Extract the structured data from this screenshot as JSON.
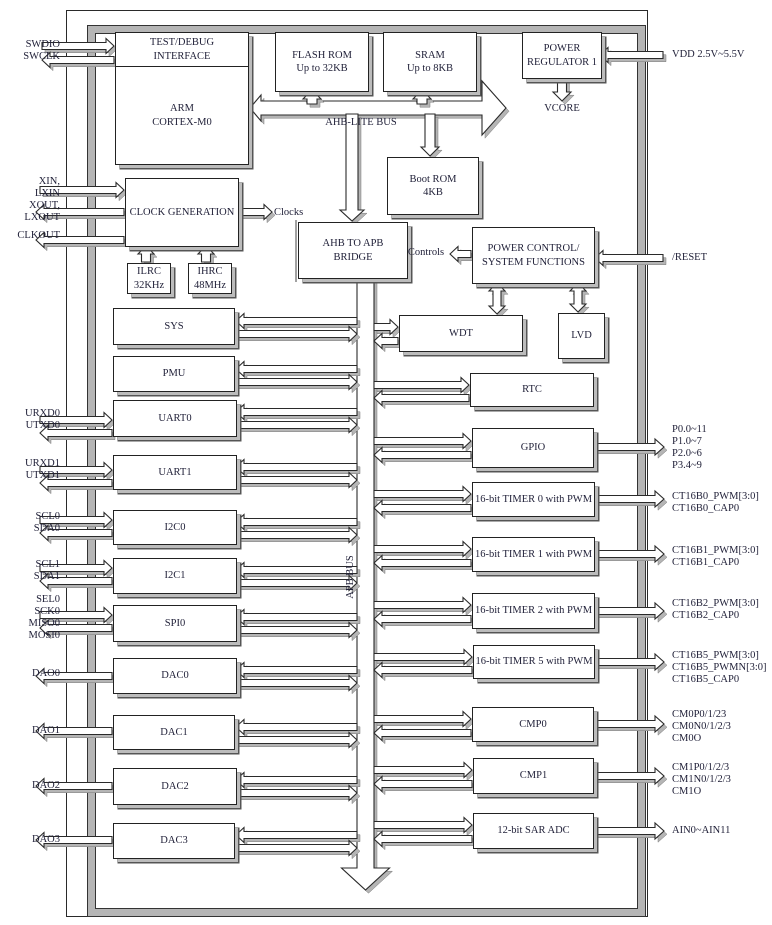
{
  "colors": {
    "line": "#2a2a2a",
    "shadow": "#b5b5b5",
    "text": "#22223a",
    "background": "#ffffff"
  },
  "blocks": {
    "test_debug": "TEST/DEBUG\nINTERFACE",
    "arm": "ARM\nCORTEX-M0",
    "flash": "FLASH ROM\nUp to 32KB",
    "sram": "SRAM\nUp to 8KB",
    "power_regulator": "POWER\nREGULATOR 1",
    "clock_generation": "CLOCK GENERATION",
    "ilrc": "ILRC\n32KHz",
    "ihrc": "IHRC\n48MHz",
    "boot_rom": "Boot ROM\n4KB",
    "ahb_apb_bridge": "AHB TO APB\nBRIDGE",
    "power_control": "POWER CONTROL/\nSYSTEM FUNCTIONS",
    "wdt": "WDT",
    "lvd": "LVD",
    "rtc": "RTC",
    "sys": "SYS",
    "pmu": "PMU",
    "uart0": "UART0",
    "uart1": "UART1",
    "i2c0": "I2C0",
    "i2c1": "I2C1",
    "spi0": "SPI0",
    "dac0": "DAC0",
    "dac1": "DAC1",
    "dac2": "DAC2",
    "dac3": "DAC3",
    "gpio": "GPIO",
    "timer0": "16-bit TIMER 0 with PWM",
    "timer1": "16-bit TIMER 1 with PWM",
    "timer2": "16-bit TIMER 2 with PWM",
    "timer5": "16-bit TIMER 5 with PWM",
    "cmp0": "CMP0",
    "cmp1": "CMP1",
    "adc": "12-bit SAR ADC"
  },
  "buses": {
    "ahb": "AHB-LITE BUS",
    "apb": "APB BUS"
  },
  "signals": {
    "clocks": "Clocks",
    "controls": "Controls",
    "vcore": "VCORE"
  },
  "pins_left": [
    "SWDIO\nSWCLK",
    "XIN,\nLXIN",
    "XOUT,\nLXOUT",
    "CLKOUT",
    "URXD0\nUTXD0",
    "URXD1\nUTXD1",
    "SCL0\nSDA0",
    "SCL1\nSDA1",
    "SEL0\nSCK0\nMISO0\nMOSI0",
    "DAO0",
    "DAO1",
    "DAO2",
    "DAO3"
  ],
  "pins_right": [
    "VDD 2.5V~5.5V",
    "/RESET",
    "P0.0~11\nP1.0~7\nP2.0~6\nP3.4~9",
    "CT16B0_PWM[3:0]\nCT16B0_CAP0",
    "CT16B1_PWM[3:0]\nCT16B1_CAP0",
    "CT16B2_PWM[3:0]\nCT16B2_CAP0",
    "CT16B5_PWM[3:0]\nCT16B5_PWMN[3:0]\nCT16B5_CAP0",
    "CM0P0/1/23\nCM0N0/1/2/3\nCM0O",
    "CM1P0/1/2/3\nCM1N0/1/2/3\nCM1O",
    "AIN0~AIN11"
  ]
}
